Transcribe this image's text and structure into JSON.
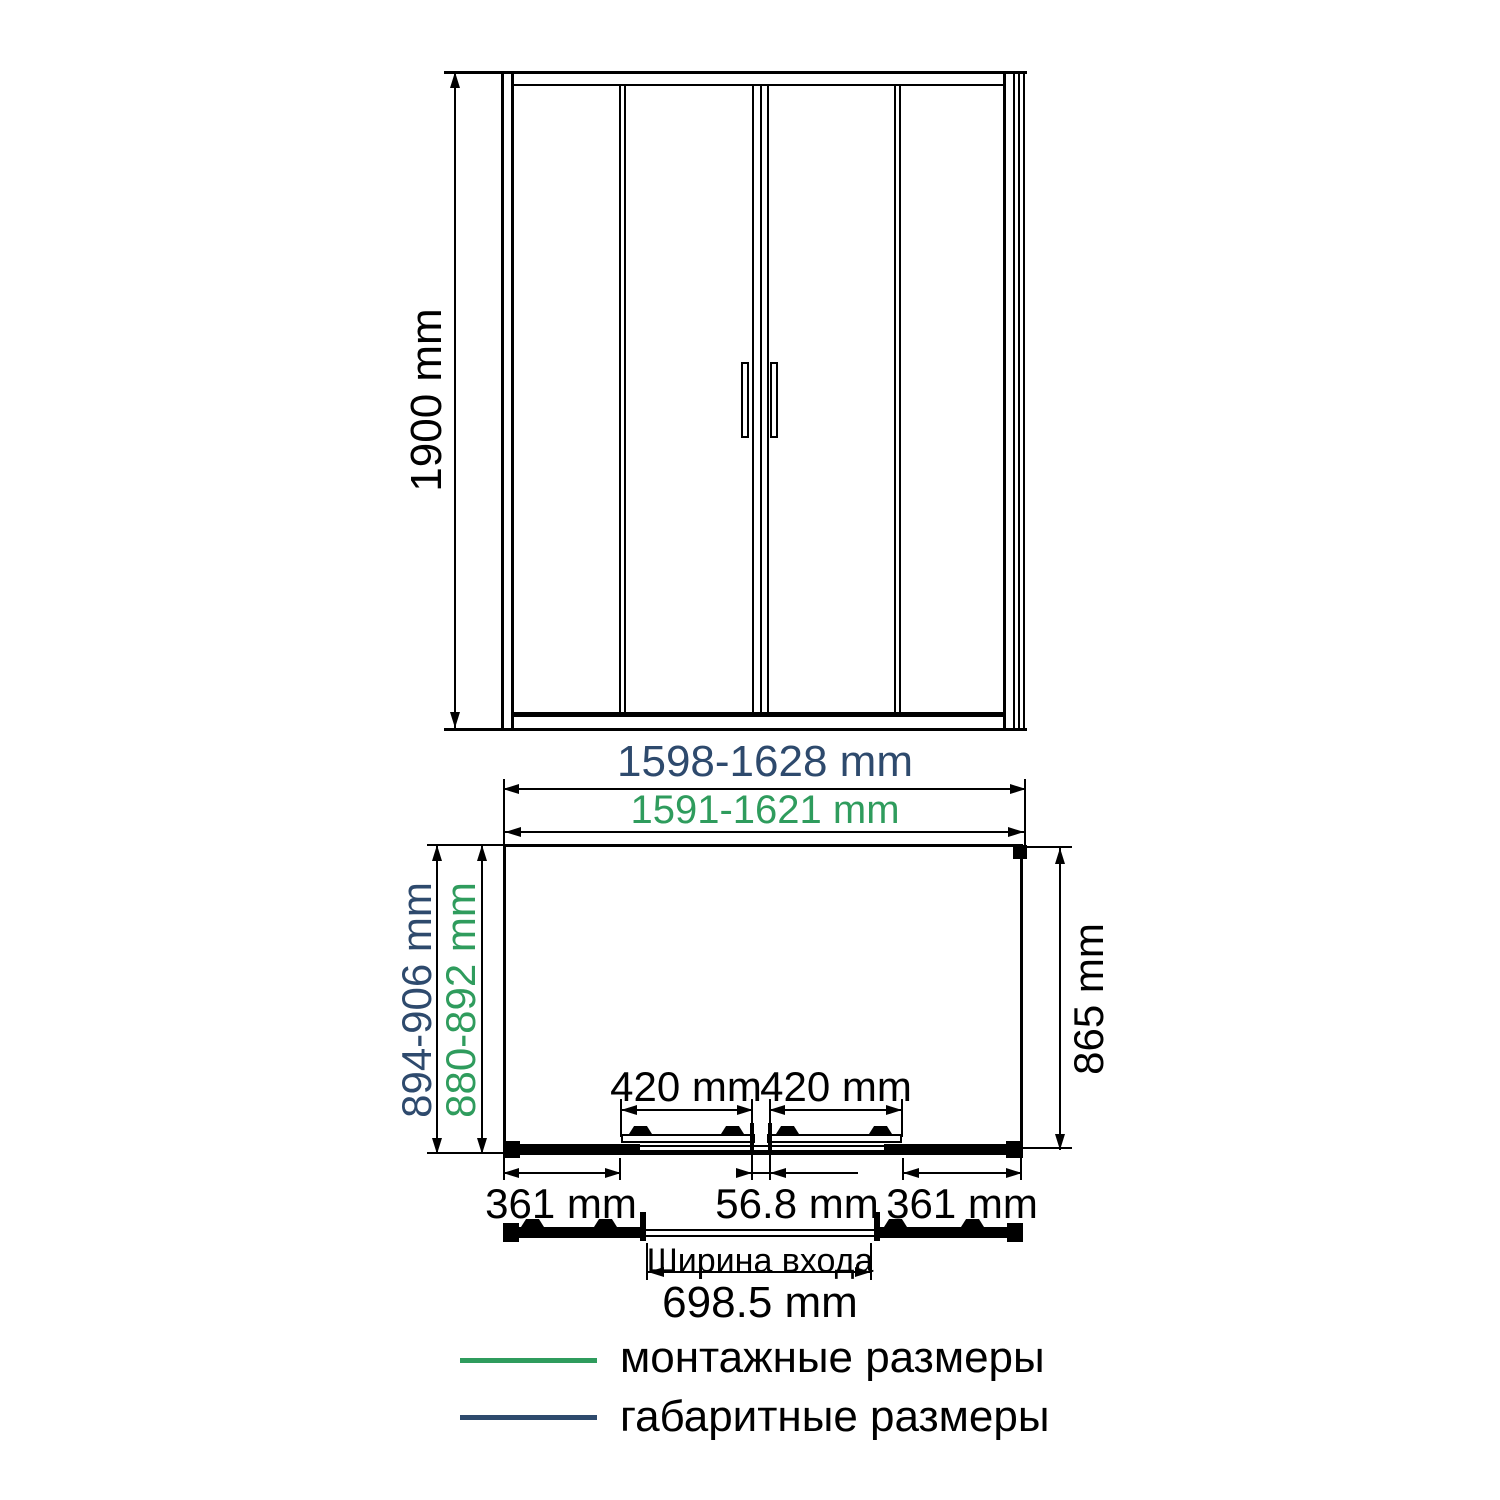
{
  "colors": {
    "overall_dimension": "#2e4a6d",
    "mounting_dimension": "#2f9c5d",
    "drawing_line": "#000000"
  },
  "front_view": {
    "height": "1900 mm"
  },
  "plan_view": {
    "overall_width": "1598-1628 mm",
    "mounting_width": "1591-1621 mm",
    "overall_depth": "894-906 mm",
    "mounting_depth": "880-892 mm",
    "right_depth": "865 mm",
    "door_left_width": "420 mm",
    "door_right_width": "420 mm",
    "fixed_panel_left_width": "361 mm",
    "center_overlap_width": "56.8 mm",
    "fixed_panel_right_width": "361 mm",
    "entrance_caption": "Ширина входа",
    "entrance_width": "698.5 mm"
  },
  "legend": {
    "items": [
      {
        "label": "монтажные размеры",
        "color": "#2f9c5d"
      },
      {
        "label": "габаритные размеры",
        "color": "#2e4a6d"
      }
    ]
  }
}
